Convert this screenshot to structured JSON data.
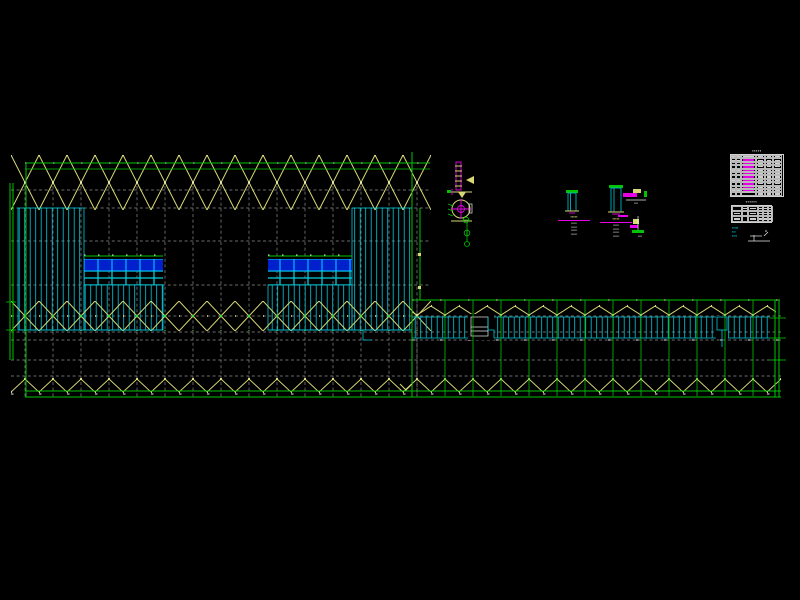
{
  "colors": {
    "background": "#000000",
    "bracing_yellow": "#d8d874",
    "grid_green": "#00c400",
    "hatch_cyan": "#00c8dc",
    "bright_cyan": "#00eaff",
    "fill_blue": "#0020cc",
    "annotation_magenta": "#e800e8",
    "line_white": "#d6d6d6",
    "grid_gray": "#8f8f8f"
  },
  "tables": {
    "material_table": {
      "title": "▪▪▪▪▪",
      "rows": 12,
      "cols": 6,
      "magenta_col": 2
    },
    "summary_table": {
      "title": "▪▪▪▪▪▪",
      "rows": 3,
      "cols": 6
    },
    "note_lines": [
      "▪▪▪▪▪",
      "▪▪▪",
      "▪▪▪▪"
    ]
  },
  "details": {
    "section_detail_1": {
      "title": "▪▪▪▪▪",
      "notes": [
        "▪▪▪▪▪▪",
        "▪▪▪▪▪▪",
        "▪▪▪▪▪▪",
        "▪▪▪▪▪▪"
      ]
    },
    "section_detail_2": {
      "title": "▪▪▪▪▪",
      "notes": [
        "▪▪▪▪▪▪",
        "▪▪▪▪▪▪",
        "▪▪▪▪▪▪",
        "▪▪▪▪▪▪"
      ]
    },
    "misc_detail_1": {
      "label": "▪▪▪▪"
    },
    "misc_detail_2": {
      "label": "▪▪▪▪"
    },
    "misc_detail_2_side": {
      "label": "▪▪"
    }
  }
}
